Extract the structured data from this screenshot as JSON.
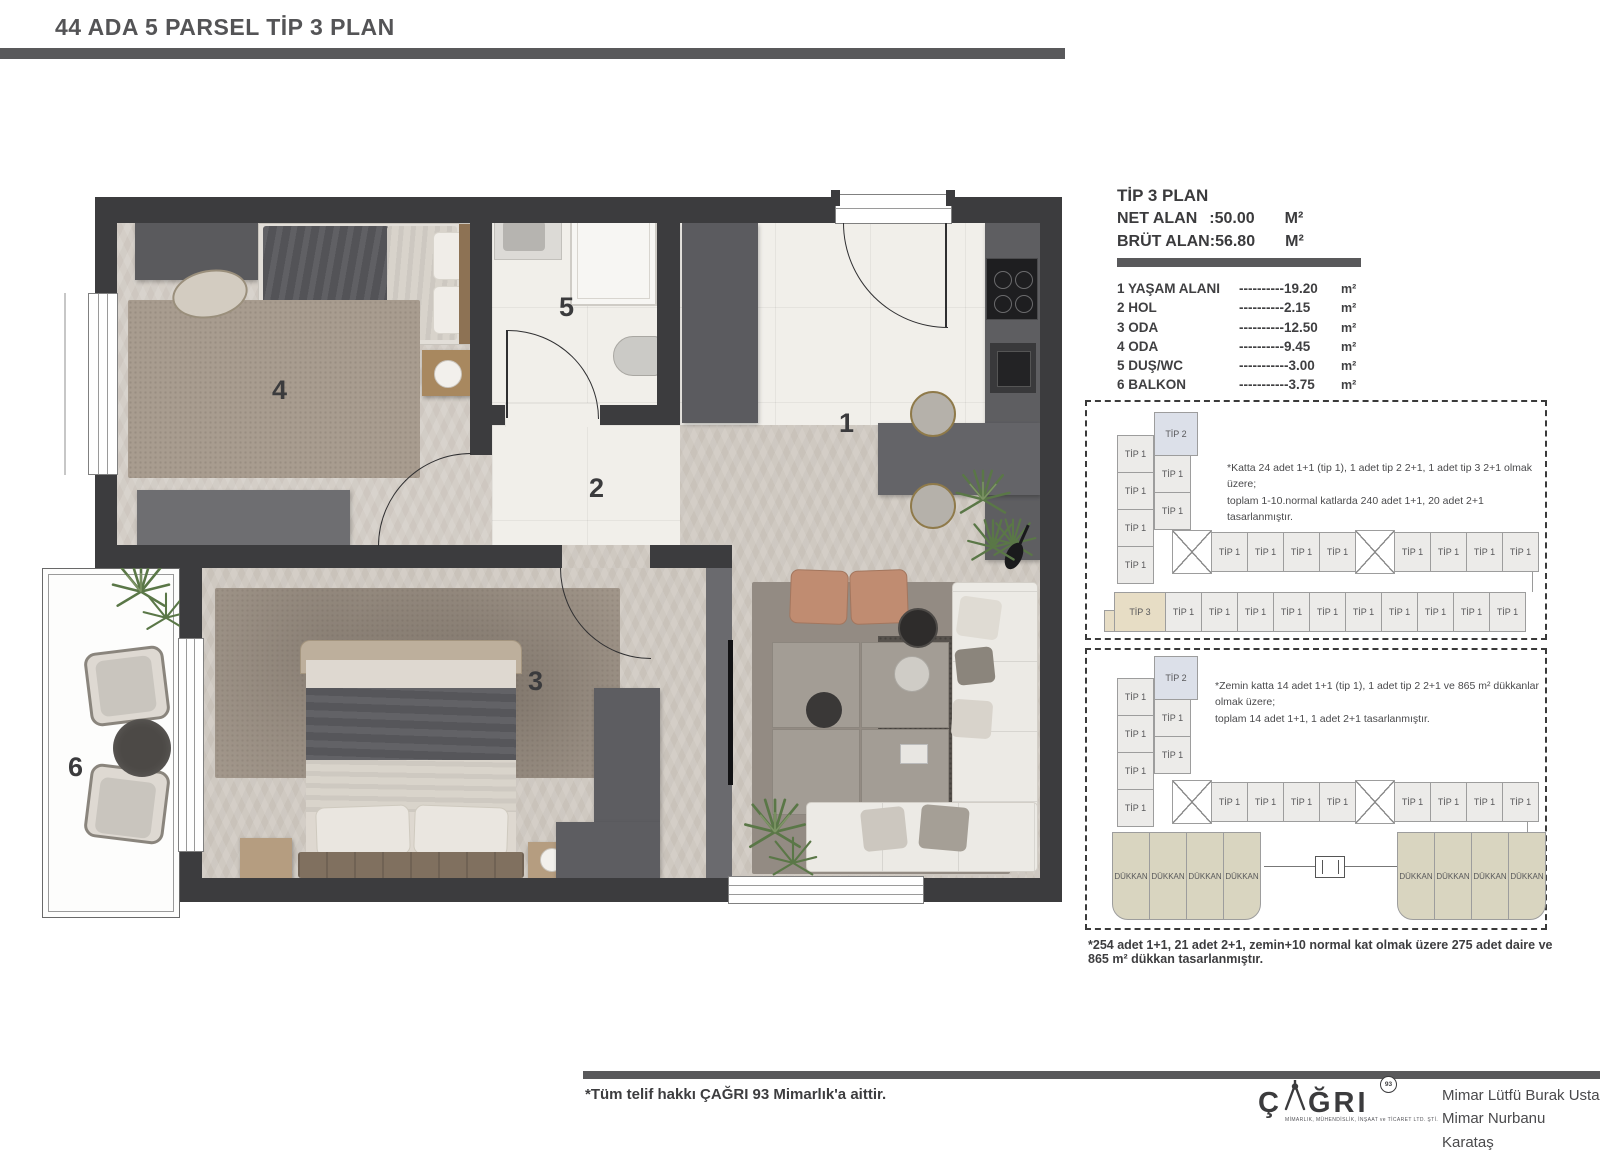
{
  "header": {
    "title": "44 ADA 5 PARSEL  TİP 3 PLAN"
  },
  "info": {
    "title": "TİP 3 PLAN",
    "net_label": "NET ALAN",
    "net_value": ":50.00",
    "net_unit": "M²",
    "brut_label": "BRÜT ALAN:",
    "brut_value": "56.80",
    "brut_unit": "M²",
    "rooms": [
      {
        "name": "1 YAŞAM ALANI",
        "dashes": "----------",
        "value": "19.20",
        "unit": "m²"
      },
      {
        "name": "2 HOL",
        "dashes": "----------",
        "value": "2.15",
        "unit": "m²"
      },
      {
        "name": "3 ODA",
        "dashes": "----------",
        "value": "12.50",
        "unit": "m²"
      },
      {
        "name": "4 ODA",
        "dashes": "----------",
        "value": "9.45",
        "unit": "m²"
      },
      {
        "name": "5 DUŞ/WC",
        "dashes": "-----------",
        "value": "3.00",
        "unit": "m²"
      },
      {
        "name": "6 BALKON",
        "dashes": "-----------",
        "value": "3.75",
        "unit": "m²"
      }
    ]
  },
  "plan": {
    "labels": {
      "r1": "1",
      "r2": "2",
      "r3": "3",
      "r4": "4",
      "r5": "5",
      "r6": "6"
    }
  },
  "diagram_upper": {
    "note_line1": "*Katta 24 adet 1+1 (tip 1), 1 adet tip 2 2+1, 1 adet tip 3 2+1 olmak üzere;",
    "note_line2": "toplam 1-10.normal katlarda 240 adet 1+1, 20 adet 2+1 tasarlanmıştır.",
    "col1": [
      "TİP 1",
      "TİP 1",
      "TİP 1",
      "TİP 1"
    ],
    "col2_top": "TİP 2",
    "col2_rest": [
      "TİP 1",
      "TİP 1"
    ],
    "mid_left": [
      "TİP 1",
      "TİP 1",
      "TİP 1",
      "TİP 1"
    ],
    "mid_right": [
      "TİP 1",
      "TİP 1",
      "TİP 1",
      "TİP 1"
    ],
    "bottom_first": "TİP 3",
    "bottom_rest": [
      "TİP 1",
      "TİP 1",
      "TİP 1",
      "TİP 1",
      "TİP 1",
      "TİP 1",
      "TİP 1",
      "TİP 1",
      "TİP 1",
      "TİP 1"
    ]
  },
  "diagram_lower": {
    "note_line1": "*Zemin katta 14 adet 1+1 (tip 1), 1 adet tip 2 2+1 ve 865 m² dükkanlar olmak üzere;",
    "note_line2": "toplam 14 adet 1+1, 1 adet 2+1 tasarlanmıştır.",
    "col1": [
      "TİP 1",
      "TİP 1",
      "TİP 1",
      "TİP 1"
    ],
    "col2_top": "TİP 2",
    "col2_rest": [
      "TİP 1",
      "TİP 1"
    ],
    "mid_left": [
      "TİP 1",
      "TİP 1",
      "TİP 1",
      "TİP 1"
    ],
    "mid_right": [
      "TİP 1",
      "TİP 1",
      "TİP 1",
      "TİP 1"
    ],
    "shops_left": [
      "DÜKKAN",
      "DÜKKAN",
      "DÜKKAN",
      "DÜKKAN"
    ],
    "shops_right": [
      "DÜKKAN",
      "DÜKKAN",
      "DÜKKAN",
      "DÜKKAN"
    ]
  },
  "footnote": "*254 adet 1+1, 21 adet 2+1, zemin+10 normal kat olmak üzere 275 adet daire ve 865 m² dükkan tasarlanmıştır.",
  "footer": {
    "copyright": "*Tüm telif hakkı ÇAĞRI 93 Mimarlık'a aittir.",
    "logo_c": "Ç",
    "logo_rest": "ĞRI",
    "logo_badge": "93",
    "logo_tagline": "MİMARLIK, MÜHENDİSLİK, İNŞAAT ve TİCARET LTD. ŞTİ.",
    "architect1": "Mimar Lütfü Burak Usta",
    "architect2": "Mimar Nurbanu Karataş"
  },
  "colors": {
    "wall": "#3c3c3e",
    "bar": "#59595b",
    "tip2": "#dce0e9",
    "tip3": "#e7ddc5",
    "shop": "#d9d5c0"
  }
}
